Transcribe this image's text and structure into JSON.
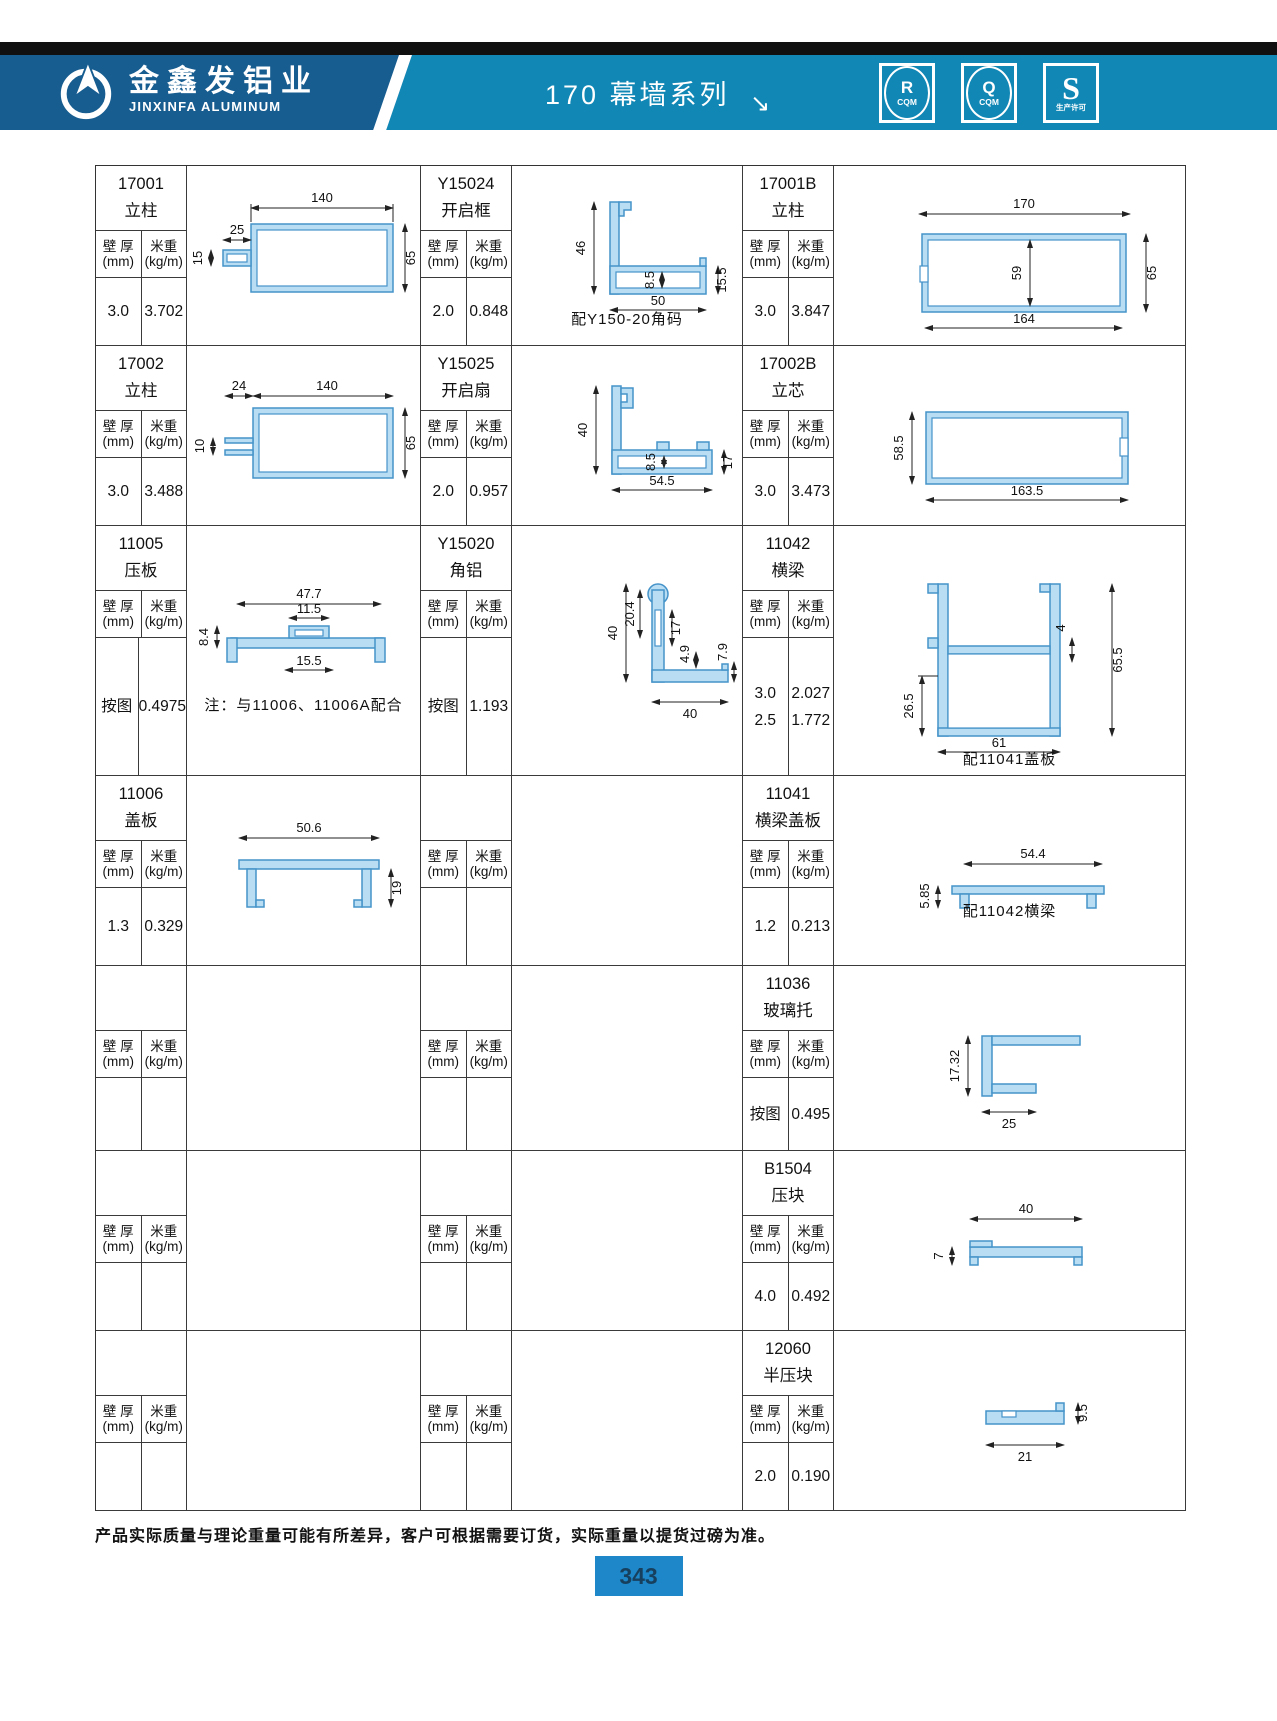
{
  "header": {
    "brand_cn": "金鑫发铝业",
    "brand_en": "JINXINFA ALUMINUM",
    "series_title": "170 幕墙系列",
    "arrow": "↘",
    "badges": [
      {
        "letter": "R",
        "sub": "CQM"
      },
      {
        "letter": "Q",
        "sub": "CQM"
      },
      {
        "letter": "S",
        "sub": "生产许可"
      }
    ]
  },
  "table": {
    "sub": {
      "wall": "壁 厚",
      "wall_u": "(mm)",
      "weight": "米重",
      "weight_u": "(kg/m)"
    }
  },
  "cells": {
    "r1c1": {
      "model": "17001",
      "name": "立柱",
      "wall": "3.0",
      "weight": "3.702",
      "dims": [
        "140",
        "25",
        "15",
        "65"
      ]
    },
    "r1c2": {
      "model": "Y15024",
      "name": "开启框",
      "wall": "2.0",
      "weight": "0.848",
      "dims": [
        "46",
        "8.5",
        "50",
        "15.5"
      ],
      "note": "配Y150-20角码"
    },
    "r1c3": {
      "model": "17001B",
      "name": "立柱",
      "wall": "3.0",
      "weight": "3.847",
      "dims": [
        "170",
        "59",
        "65",
        "164"
      ]
    },
    "r2c1": {
      "model": "17002",
      "name": "立柱",
      "wall": "3.0",
      "weight": "3.488",
      "dims": [
        "24",
        "140",
        "10",
        "65"
      ]
    },
    "r2c2": {
      "model": "Y15025",
      "name": "开启扇",
      "wall": "2.0",
      "weight": "0.957",
      "dims": [
        "40",
        "8.5",
        "54.5",
        "17"
      ]
    },
    "r2c3": {
      "model": "17002B",
      "name": "立芯",
      "wall": "3.0",
      "weight": "3.473",
      "dims": [
        "58.5",
        "163.5"
      ]
    },
    "r3c1": {
      "model": "11005",
      "name": "压板",
      "wall": "按图",
      "weight": "0.4975",
      "dims": [
        "47.7",
        "11.5",
        "8.4",
        "15.5"
      ],
      "note": "注：与11006、11006A配合"
    },
    "r3c2": {
      "model": "Y15020",
      "name": "角铝",
      "wall": "按图",
      "weight": "1.193",
      "dims": [
        "40",
        "20.4",
        "17",
        "4.9",
        "7.9",
        "40"
      ]
    },
    "r3c3": {
      "model": "11042",
      "name": "横梁",
      "wall": "3.0\n2.5",
      "weight": "2.027\n1.772",
      "dims": [
        "4",
        "65.5",
        "26.5",
        "61"
      ],
      "note": "配11041盖板"
    },
    "r4c1": {
      "model": "11006",
      "name": "盖板",
      "wall": "1.3",
      "weight": "0.329",
      "dims": [
        "50.6",
        "19"
      ]
    },
    "r4c3": {
      "model": "11041",
      "name": "横梁盖板",
      "wall": "1.2",
      "weight": "0.213",
      "dims": [
        "5.85",
        "54.4"
      ],
      "note": "配11042横梁"
    },
    "r5c3": {
      "model": "11036",
      "name": "玻璃托",
      "wall": "按图",
      "weight": "0.495",
      "dims": [
        "17.32",
        "25"
      ]
    },
    "r6c3": {
      "model": "B1504",
      "name": "压块",
      "wall": "4.0",
      "weight": "0.492",
      "dims": [
        "40",
        "7"
      ]
    },
    "r7c3": {
      "model": "12060",
      "name": "半压块",
      "wall": "2.0",
      "weight": "0.190",
      "dims": [
        "21",
        "9.5"
      ]
    }
  },
  "footer": {
    "note": "产品实际质量与理论重量可能有所差异，客户可根据需要订货，实际重量以提货过磅为准。",
    "page": "343"
  },
  "colors": {
    "band_dark": "#175d90",
    "band_teal": "#1187b5",
    "profile_fill": "#b9ddf3",
    "profile_stroke": "#4593c9",
    "page_box": "#1d87c9"
  }
}
